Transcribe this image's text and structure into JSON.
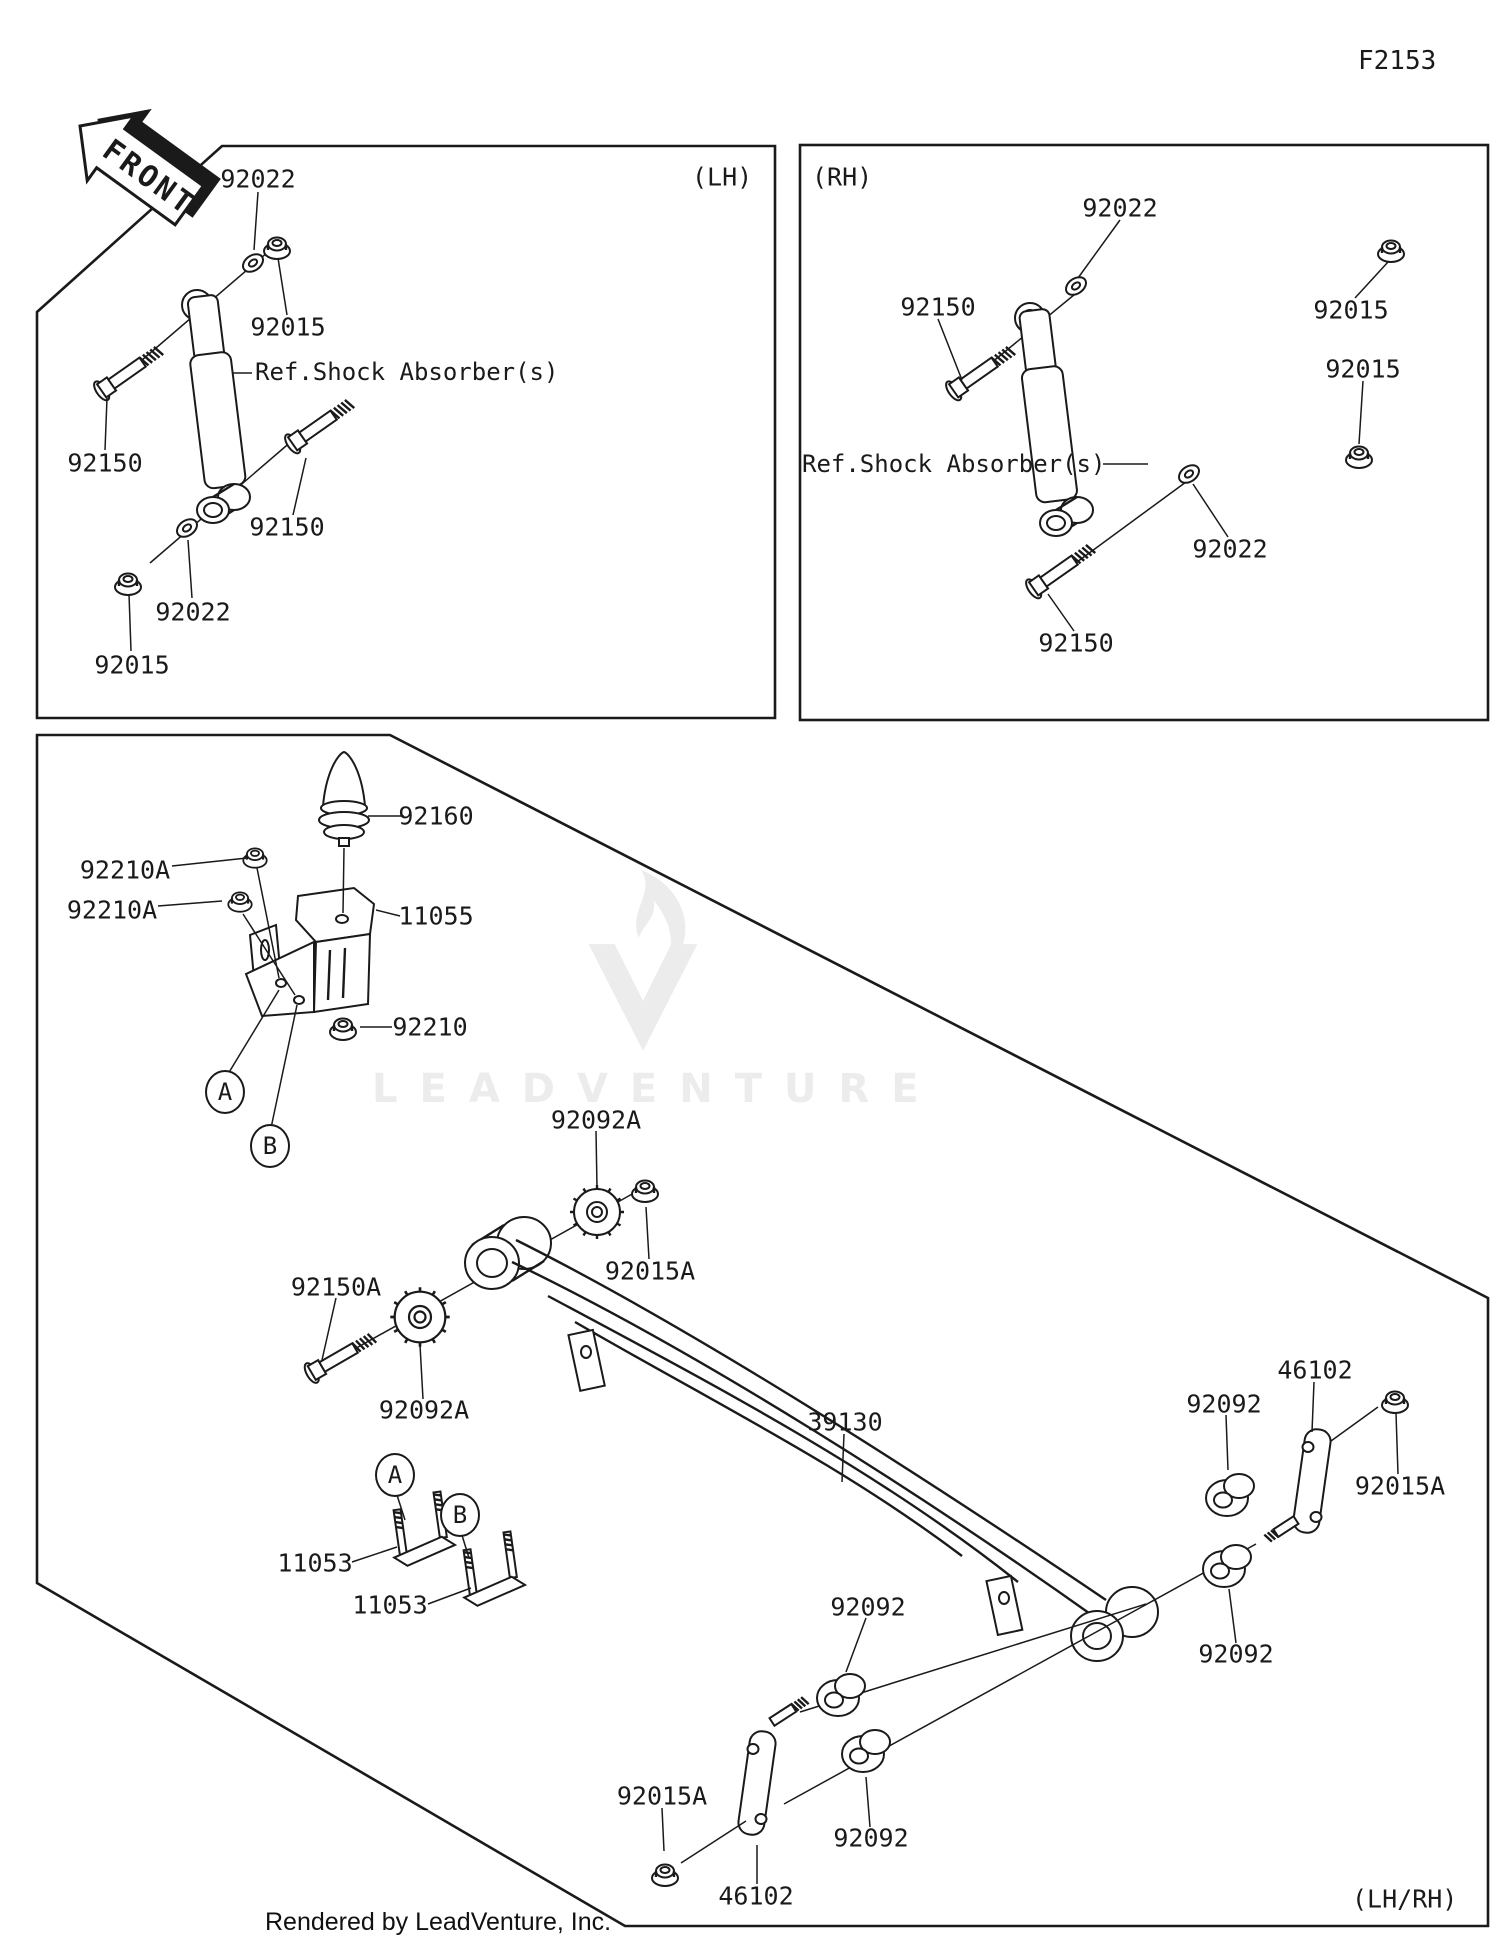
{
  "page": {
    "figure_code": "F2153",
    "watermark_text": "LEADVENTURE",
    "credit": "Rendered by LeadVenture, Inc.",
    "side_note": "(LH/RH)"
  },
  "front_arrow": {
    "label": "FRONT"
  },
  "lh_panel": {
    "title": "(LH)",
    "ref_label": "Ref.Shock Absorber(s)",
    "washer_top": "92022",
    "nut_top": "92015",
    "bolt_upper": "92150",
    "bolt_lower": "92150",
    "washer_bottom": "92022",
    "nut_bottom": "92015"
  },
  "rh_panel": {
    "title": "(RH)",
    "ref_label": "Ref.Shock Absorber(s)",
    "washer_top": "92022",
    "nut_top": "92015",
    "nut_mid": "92015",
    "bolt_upper": "92150",
    "washer_bottom": "92022",
    "bolt_lower": "92150"
  },
  "main_panel": {
    "bump_stop": "92160",
    "bracket_nut_1": "92210A",
    "bracket_nut_2": "92210A",
    "bracket": "11055",
    "bracket_nut_3": "92210",
    "marker_a": "A",
    "marker_b": "B",
    "marker_a2": "A",
    "marker_b2": "B",
    "spline_bushing_top": "92092A",
    "spline_nut": "92015A",
    "front_bolt": "92150A",
    "spline_bushing_bottom": "92092A",
    "leaf_spring": "39130",
    "ubolt_1": "11053",
    "ubolt_2": "11053",
    "shackle_plate_right": "46102",
    "bushing_right_top": "92092",
    "shackle_nut_right": "92015A",
    "bushing_right_bottom": "92092",
    "bushing_center_top": "92092",
    "bushing_center_bottom": "92092",
    "shackle_nut_center": "92015A",
    "shackle_plate_center": "46102"
  }
}
